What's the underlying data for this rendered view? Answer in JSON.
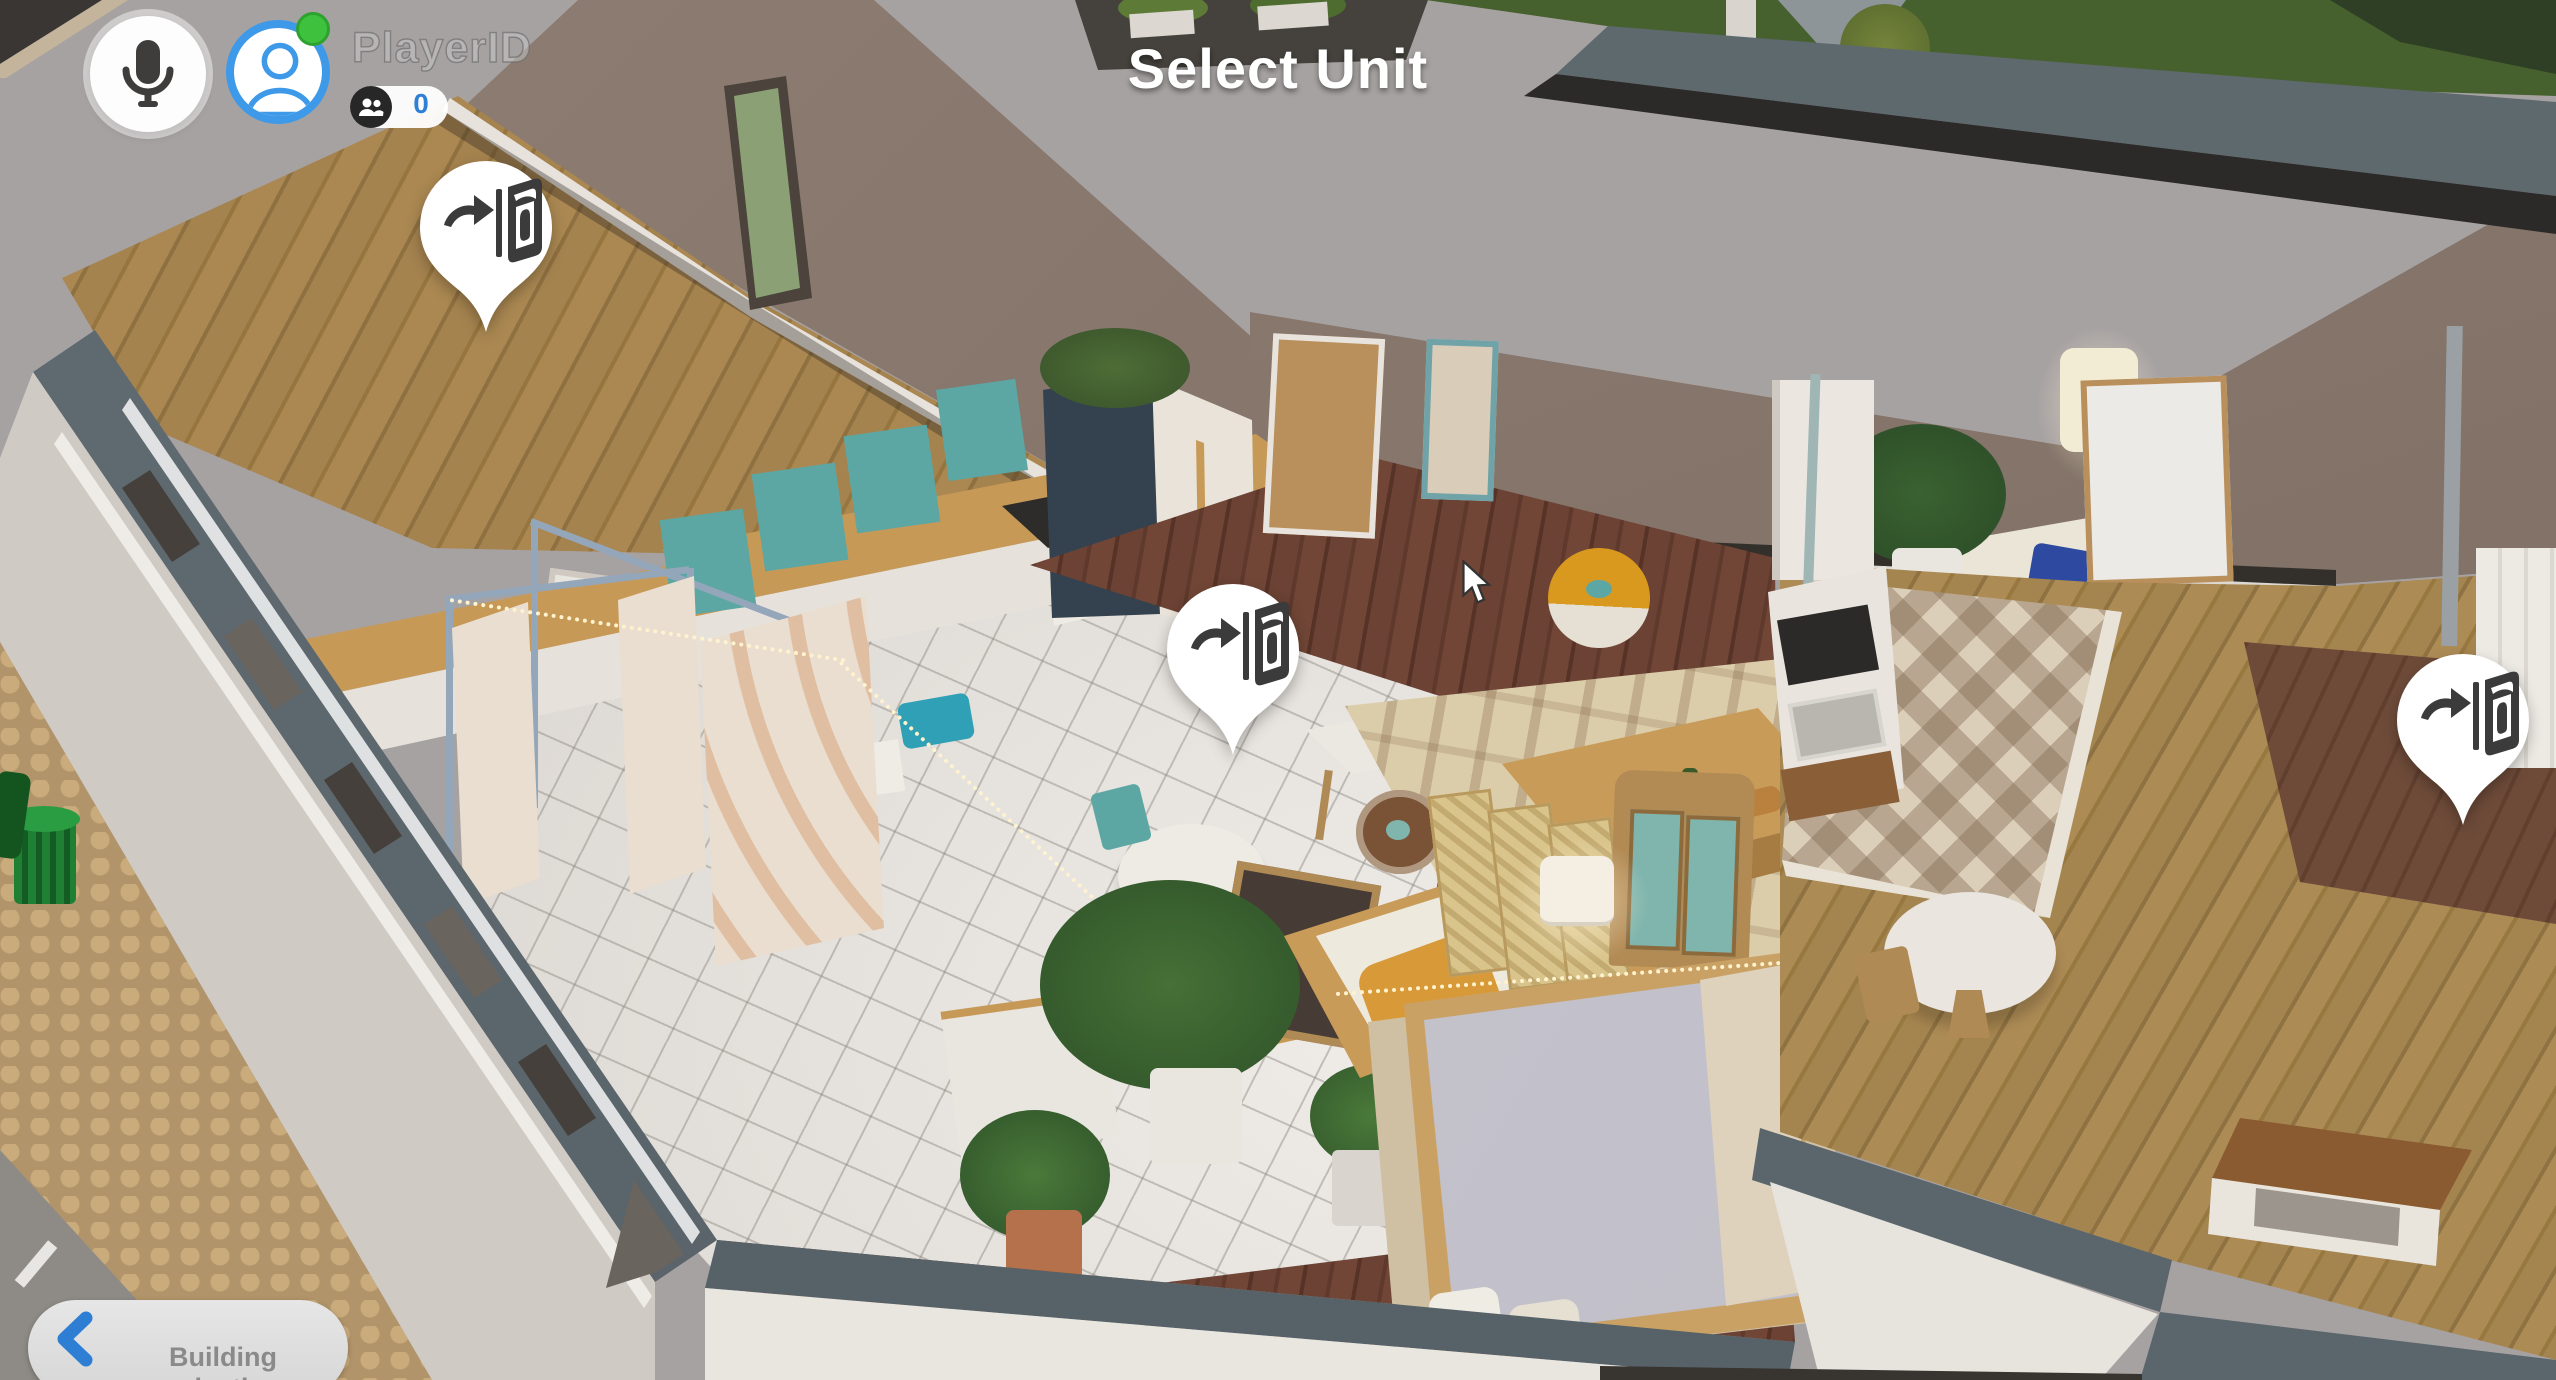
{
  "hud": {
    "title": "Select Unit",
    "player": {
      "name": "PlayerID",
      "status": "online",
      "avatar_icon": "person-avatar-icon",
      "status_icon": "online-status-dot"
    },
    "mic_button": {
      "icon": "microphone-icon"
    },
    "spectators": {
      "icon": "people-icon",
      "count": "0"
    },
    "back_button": {
      "icon": "chevron-left-icon",
      "label": "Building selection"
    },
    "unit_pins": {
      "icon": "enter-door-icon",
      "count": 3
    },
    "cursor": {
      "icon": "mouse-cursor-icon"
    }
  },
  "colors": {
    "accent_blue": "#2e7fd4",
    "avatar_ring_blue": "#3e9ae8",
    "online_green": "#3ec23e",
    "count_blue": "#2f7fd6",
    "pin_white": "#ffffff",
    "pin_glyph": "#3b3b3b",
    "title_white": "#ffffff",
    "button_grey": "#dcdcdc",
    "button_text_grey": "#8a8a8a"
  }
}
